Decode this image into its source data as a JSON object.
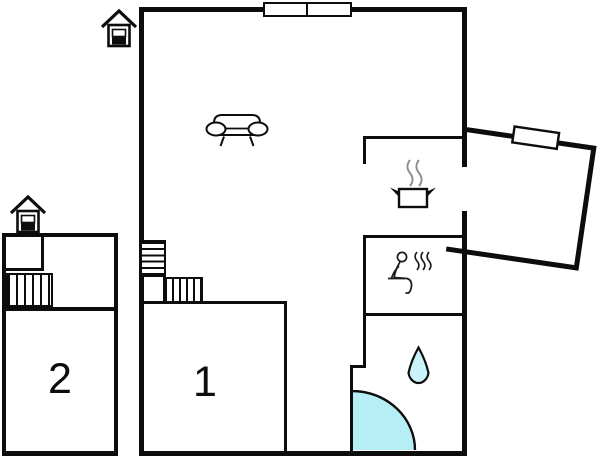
{
  "plan": {
    "type": "floor-plan",
    "rooms": {
      "room1": {
        "label": "1"
      },
      "room2": {
        "label": "2"
      }
    },
    "colors": {
      "wall": "#0d0d0d",
      "shower_fill": "#b5eef4",
      "drop_fill": "#c8f3f8",
      "steam_gray": "#8f8f8f"
    },
    "icons": {
      "entrance_main": "house-entrance-icon",
      "entrance_annex": "house-entrance-icon",
      "sofa": "sofa-icon",
      "stove": "cooking-pot-icon",
      "sauna": "sauna-person-icon",
      "water_drop": "water-drop-icon",
      "shower": "shower-quarter-circle"
    }
  }
}
